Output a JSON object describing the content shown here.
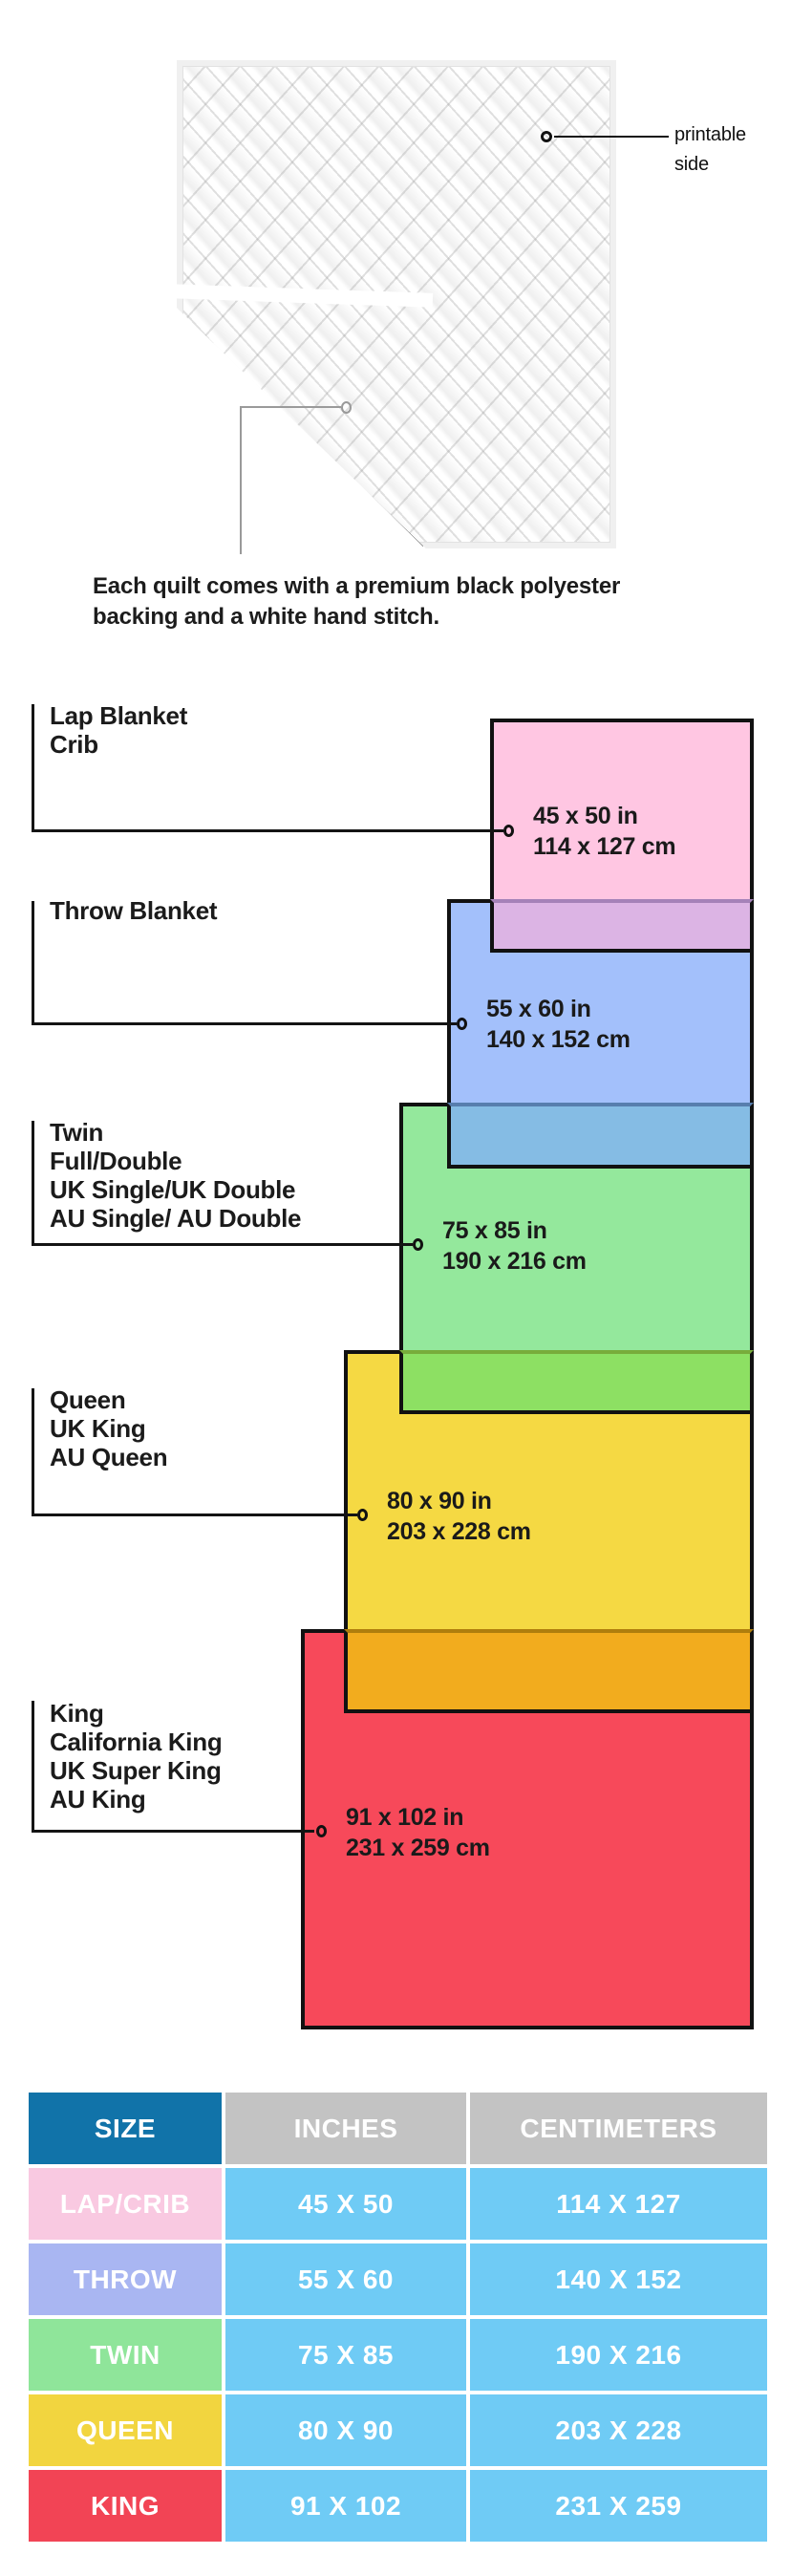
{
  "quilt": {
    "printable_side_line1": "printable",
    "printable_side_line2": "side",
    "caption_line1": "Each quilt comes with a premium black polyester",
    "caption_line2": "backing and a white hand stitch."
  },
  "diagram": {
    "sizes": [
      {
        "names": [
          "Lap Blanket",
          "Crib"
        ],
        "inches": "45 x 50 in",
        "cm": "114 x 127 cm",
        "fill": "#FFC6E2",
        "overlap_fill": "#DCB4E4"
      },
      {
        "names": [
          "Throw Blanket"
        ],
        "inches": "55 x 60 in",
        "cm": "140 x 152 cm",
        "fill": "#A3C0FB",
        "overlap_fill": "#85BCE4"
      },
      {
        "names": [
          "Twin",
          "Full/Double",
          "UK Single/UK Double",
          "AU Single/ AU Double"
        ],
        "inches": "75 x 85 in",
        "cm": "190 x 216 cm",
        "fill": "#94E89C",
        "overlap_fill": "#8DE063"
      },
      {
        "names": [
          "Queen",
          "UK King",
          "AU Queen"
        ],
        "inches": "80 x 90 in",
        "cm": "203 x 228 cm",
        "fill": "#F5D943",
        "overlap_fill": "#F2AC1E"
      },
      {
        "names": [
          "King",
          "California King",
          "UK Super King",
          "AU King"
        ],
        "inches": "91 x 102 in",
        "cm": "231 x 259 cm",
        "fill": "#F7495A",
        "overlap_fill": ""
      }
    ]
  },
  "table": {
    "headers": [
      "SIZE",
      "INCHES",
      "CENTIMETERS"
    ],
    "header_size_bg": "#1173A9",
    "header_other_bg": "#C3C3C3",
    "value_bg": "#6FCBF5",
    "rows": [
      {
        "size": "LAP/CRIB",
        "inches": "45 X 50",
        "cm": "114 X 127",
        "bg": "#F9C9E1"
      },
      {
        "size": "THROW",
        "inches": "55 X 60",
        "cm": "140 X 152",
        "bg": "#A9B6F2"
      },
      {
        "size": "TWIN",
        "inches": "75 X 85",
        "cm": "190 X 216",
        "bg": "#8FE59A"
      },
      {
        "size": "QUEEN",
        "inches": "80 X 90",
        "cm": "203 X 228",
        "bg": "#F2D53F"
      },
      {
        "size": "KING",
        "inches": "91 X 102",
        "cm": "231 X 259",
        "bg": "#F24455"
      }
    ]
  }
}
